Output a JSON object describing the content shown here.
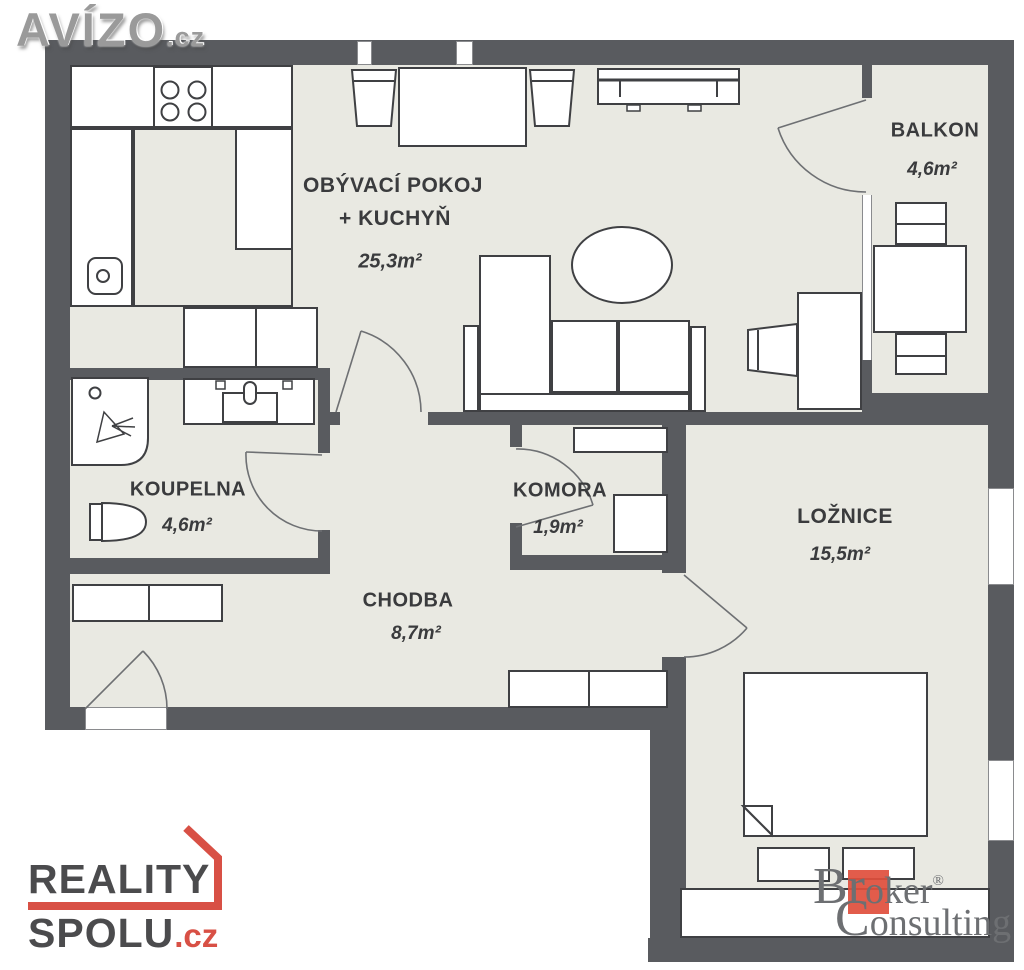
{
  "watermarks": {
    "avizo": {
      "text": "AVÍZO",
      "suffix": ".cz"
    },
    "reality_spolu": {
      "line1": "REALITY",
      "line2": "SPOLU",
      "suffix": ".cz"
    },
    "broker_consulting": {
      "b1": "Br",
      "b2": "ok",
      "b3": "er",
      "reg": "®",
      "line2_c": "C",
      "line2_rest": "onsulting"
    }
  },
  "floorplan": {
    "rooms": [
      {
        "name": "OBÝVACÍ POKOJ",
        "name2": "+ KUCHYŇ",
        "area": "25,3m²"
      },
      {
        "name": "BALKON",
        "area": "4,6m²"
      },
      {
        "name": "KOUPELNA",
        "area": "4,6m²"
      },
      {
        "name": "KOMORA",
        "area": "1,9m²"
      },
      {
        "name": "CHODBA",
        "area": "8,7m²"
      },
      {
        "name": "LOŽNICE",
        "area": "15,5m²"
      }
    ],
    "colors": {
      "wall": "#595b5f",
      "floor": "#e9e9e2",
      "outline": "#3f4043",
      "arc": "#6e7073",
      "label": "#3a3b3d",
      "reality_red": "#d85045",
      "broker_red": "#e04e3c"
    }
  }
}
